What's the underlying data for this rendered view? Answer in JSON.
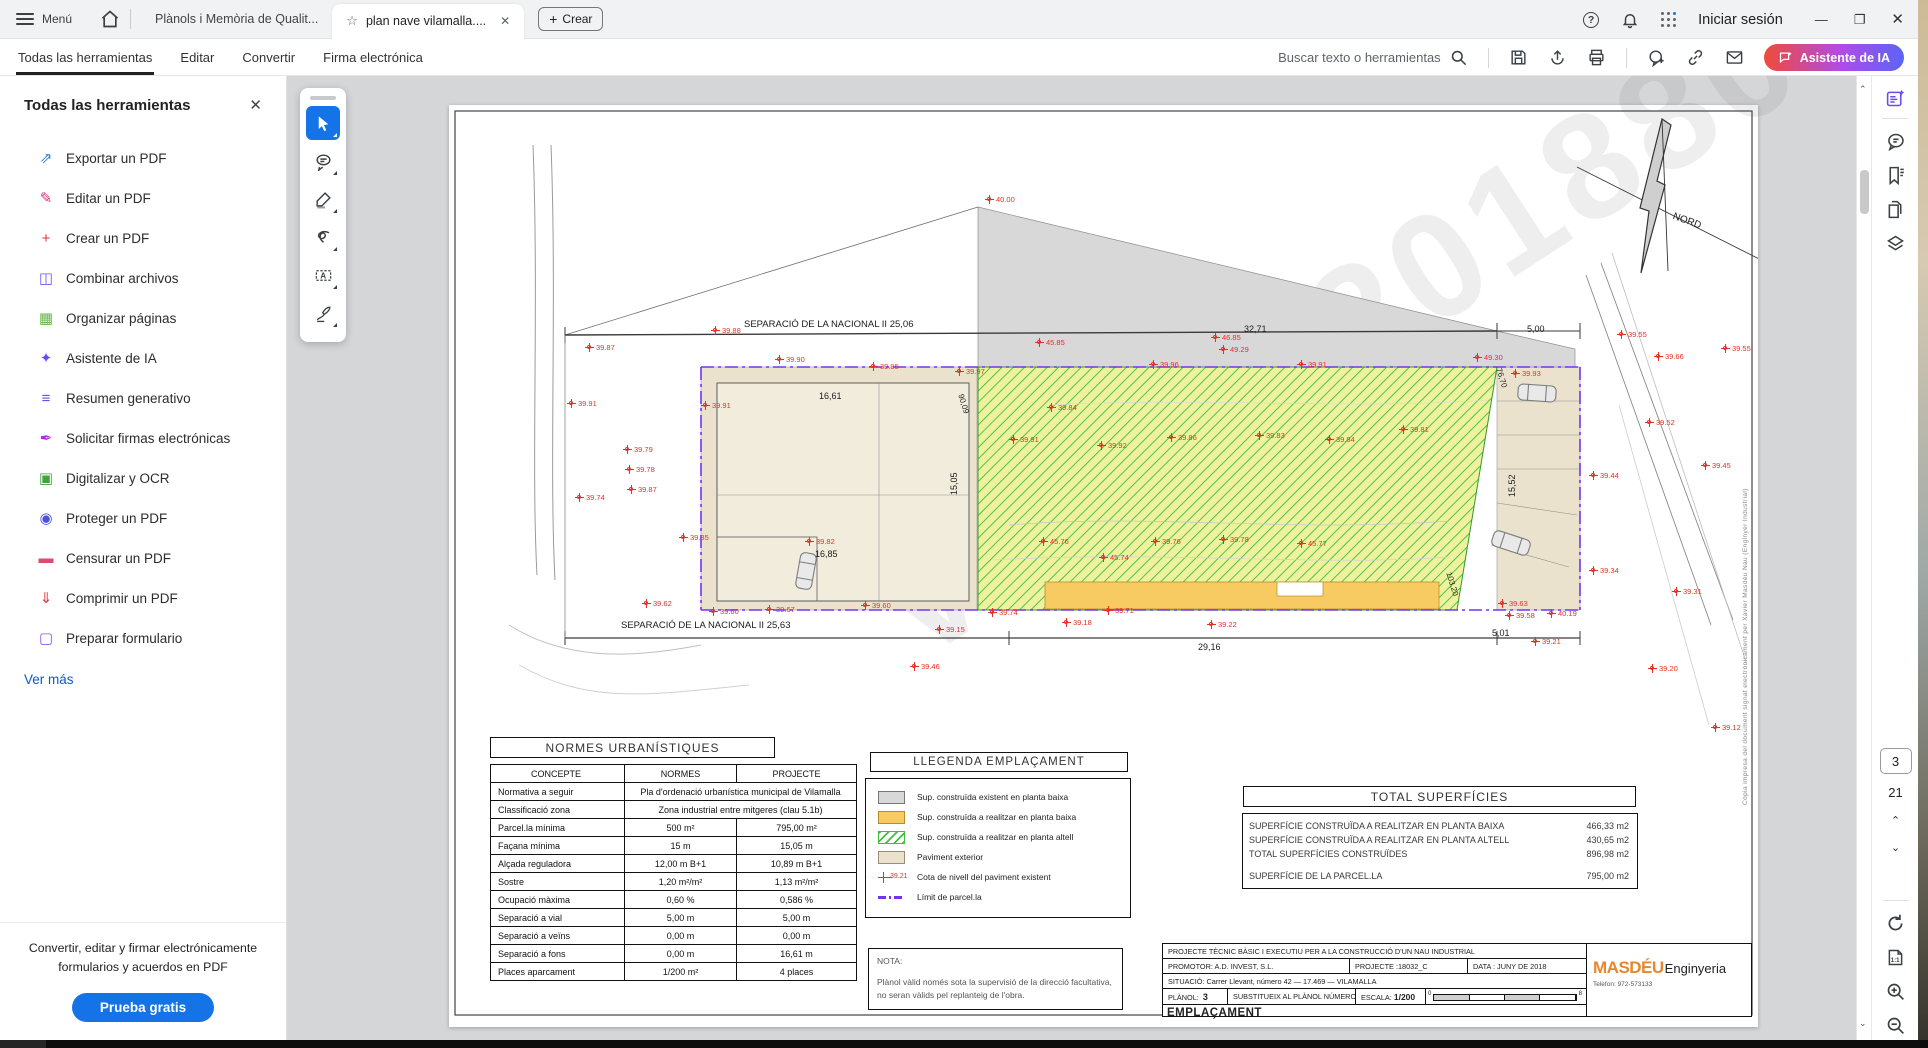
{
  "titlebar": {
    "menu": "Menú",
    "tab_inactive": "Plànols i Memòria de Qualit...",
    "tab_active": "plan nave vilamalla....",
    "create": "Crear",
    "signin": "Iniciar sesión"
  },
  "menubar": {
    "items": [
      "Todas las herramientas",
      "Editar",
      "Convertir",
      "Firma electrónica"
    ],
    "search": "Buscar texto o herramientas",
    "ai": "Asistente de IA"
  },
  "sidebar": {
    "title": "Todas las herramientas",
    "items": [
      {
        "label": "Exportar un PDF",
        "icon": "export-pdf-icon",
        "glyph": "⇗",
        "color": "#2b7de0"
      },
      {
        "label": "Editar un PDF",
        "icon": "edit-pdf-icon",
        "glyph": "✎",
        "color": "#d92d7a"
      },
      {
        "label": "Crear un PDF",
        "icon": "create-pdf-icon",
        "glyph": "+",
        "color": "#e0393b"
      },
      {
        "label": "Combinar archivos",
        "icon": "combine-files-icon",
        "glyph": "◫",
        "color": "#7155f5"
      },
      {
        "label": "Organizar páginas",
        "icon": "organize-pages-icon",
        "glyph": "▦",
        "color": "#67b346"
      },
      {
        "label": "Asistente de IA",
        "icon": "ai-assistant-icon",
        "glyph": "✦",
        "color": "#6a4cf0"
      },
      {
        "label": "Resumen generativo",
        "icon": "generative-summary-icon",
        "glyph": "≡",
        "color": "#6a4cf0"
      },
      {
        "label": "Solicitar firmas electrónicas",
        "icon": "request-signatures-icon",
        "glyph": "✒",
        "color": "#b02bd6"
      },
      {
        "label": "Digitalizar y OCR",
        "icon": "scan-ocr-icon",
        "glyph": "▣",
        "color": "#45a33f"
      },
      {
        "label": "Proteger un PDF",
        "icon": "protect-pdf-icon",
        "glyph": "◉",
        "color": "#4a53d9"
      },
      {
        "label": "Censurar un PDF",
        "icon": "redact-pdf-icon",
        "glyph": "▬",
        "color": "#d74e73"
      },
      {
        "label": "Comprimir un PDF",
        "icon": "compress-pdf-icon",
        "glyph": "⇓",
        "color": "#d9363e"
      },
      {
        "label": "Preparar formulario",
        "icon": "prepare-form-icon",
        "glyph": "▢",
        "color": "#8b53e6"
      }
    ],
    "more": "Ver más",
    "promo_line1": "Convertir, editar y firmar electrónicamente",
    "promo_line2": "formularios y acuerdos en PDF",
    "cta": "Prueba gratis"
  },
  "rightrail": {
    "page_current": "3",
    "page_total": "21"
  },
  "sheet": {
    "watermark": "VISAT 2018804",
    "side_note": "Còpia impresa del document signat electrònicament per Xavier Masdéu Nau (Enginyer Industrial)",
    "dims": [
      {
        "x": 295,
        "y": 214,
        "v": "SEPARACIÓ DE LA NACIONAL II 25,06",
        "fs": 9.5
      },
      {
        "x": 795,
        "y": 219,
        "v": "32,71"
      },
      {
        "x": 1078,
        "y": 219,
        "v": "5,00"
      },
      {
        "x": 370,
        "y": 286,
        "v": "16,61"
      },
      {
        "x": 500,
        "y": 390,
        "v": "15,05",
        "r": -90
      },
      {
        "x": 366,
        "y": 444,
        "v": "16,85"
      },
      {
        "x": 172,
        "y": 515,
        "v": "SEPARACIÓ DE LA NACIONAL II 25,63",
        "fs": 9.5
      },
      {
        "x": 749,
        "y": 537,
        "v": "29,16"
      },
      {
        "x": 1043,
        "y": 523,
        "v": "5,01"
      },
      {
        "x": 1058,
        "y": 392,
        "v": "15,52",
        "r": -90
      },
      {
        "x": 516,
        "y": 288,
        "v": "90,09",
        "r": 73,
        "fs": 8
      },
      {
        "x": 1004,
        "y": 466,
        "v": "103,20",
        "r": 73,
        "fs": 8
      },
      {
        "x": 1054,
        "y": 262,
        "v": "76,70",
        "r": 73,
        "fs": 8
      },
      {
        "x": 1226,
        "y": 106,
        "v": "NORD",
        "r": 20,
        "fs": 10
      }
    ],
    "cotas": [
      {
        "x": 536,
        "y": 90,
        "v": "40.00"
      },
      {
        "x": 262,
        "y": 221,
        "v": "39.88"
      },
      {
        "x": 136,
        "y": 238,
        "v": "39.87"
      },
      {
        "x": 586,
        "y": 233,
        "v": "45.85"
      },
      {
        "x": 762,
        "y": 228,
        "v": "46.85"
      },
      {
        "x": 770,
        "y": 240,
        "v": "49.29"
      },
      {
        "x": 326,
        "y": 250,
        "v": "39.90"
      },
      {
        "x": 420,
        "y": 257,
        "v": "39.95"
      },
      {
        "x": 506,
        "y": 262,
        "v": "39.97"
      },
      {
        "x": 700,
        "y": 255,
        "v": "39.96"
      },
      {
        "x": 848,
        "y": 255,
        "v": "39.91"
      },
      {
        "x": 1024,
        "y": 248,
        "v": "49.30"
      },
      {
        "x": 1062,
        "y": 264,
        "v": "39.93"
      },
      {
        "x": 118,
        "y": 294,
        "v": "39.91"
      },
      {
        "x": 252,
        "y": 296,
        "v": "39.91"
      },
      {
        "x": 174,
        "y": 340,
        "v": "39.79"
      },
      {
        "x": 176,
        "y": 360,
        "v": "39.78"
      },
      {
        "x": 178,
        "y": 380,
        "v": "39.87"
      },
      {
        "x": 126,
        "y": 388,
        "v": "39.74"
      },
      {
        "x": 230,
        "y": 428,
        "v": "39.85"
      },
      {
        "x": 598,
        "y": 298,
        "v": "39.84"
      },
      {
        "x": 560,
        "y": 330,
        "v": "39.91"
      },
      {
        "x": 648,
        "y": 336,
        "v": "39.92"
      },
      {
        "x": 718,
        "y": 328,
        "v": "39.86"
      },
      {
        "x": 806,
        "y": 326,
        "v": "39.83"
      },
      {
        "x": 876,
        "y": 330,
        "v": "39.84"
      },
      {
        "x": 950,
        "y": 320,
        "v": "39.81"
      },
      {
        "x": 356,
        "y": 432,
        "v": "39.82"
      },
      {
        "x": 590,
        "y": 432,
        "v": "45.76"
      },
      {
        "x": 650,
        "y": 448,
        "v": "45.74"
      },
      {
        "x": 702,
        "y": 432,
        "v": "39.76"
      },
      {
        "x": 770,
        "y": 430,
        "v": "39.78"
      },
      {
        "x": 848,
        "y": 434,
        "v": "45.77"
      },
      {
        "x": 193,
        "y": 494,
        "v": "39.62"
      },
      {
        "x": 260,
        "y": 502,
        "v": "39.60"
      },
      {
        "x": 316,
        "y": 500,
        "v": "39.67"
      },
      {
        "x": 412,
        "y": 496,
        "v": "39.60"
      },
      {
        "x": 539,
        "y": 503,
        "v": "39.74"
      },
      {
        "x": 655,
        "y": 501,
        "v": "39.71"
      },
      {
        "x": 613,
        "y": 513,
        "v": "39.18"
      },
      {
        "x": 758,
        "y": 515,
        "v": "39.22"
      },
      {
        "x": 486,
        "y": 520,
        "v": "39.15"
      },
      {
        "x": 461,
        "y": 557,
        "v": "39.46"
      },
      {
        "x": 1049,
        "y": 494,
        "v": "39.63"
      },
      {
        "x": 1056,
        "y": 506,
        "v": "39.58"
      },
      {
        "x": 1082,
        "y": 532,
        "v": "39.21"
      },
      {
        "x": 1168,
        "y": 225,
        "v": "39.55"
      },
      {
        "x": 1272,
        "y": 239,
        "v": "39.55"
      },
      {
        "x": 1205,
        "y": 247,
        "v": "39.66"
      },
      {
        "x": 1196,
        "y": 313,
        "v": "39.52"
      },
      {
        "x": 1252,
        "y": 356,
        "v": "39.45"
      },
      {
        "x": 1140,
        "y": 366,
        "v": "39.44"
      },
      {
        "x": 1140,
        "y": 461,
        "v": "39.34"
      },
      {
        "x": 1223,
        "y": 482,
        "v": "39.31"
      },
      {
        "x": 1199,
        "y": 559,
        "v": "39.20"
      },
      {
        "x": 1262,
        "y": 618,
        "v": "39.12"
      },
      {
        "x": 1098,
        "y": 504,
        "v": "40.19"
      }
    ],
    "normes": {
      "title": "NORMES URBANÍSTIQUES",
      "headers": {
        "c": "CONCEPTE",
        "n": "NORMES",
        "p": "PROJECTE"
      },
      "merged": [
        {
          "c": "Normativa a seguir",
          "v": "Pla d'ordenació urbanística municipal de Vilamalla"
        },
        {
          "c": "Classificació zona",
          "v": "Zona industrial entre mitgeres (clau 5.1b)"
        }
      ],
      "rows": [
        {
          "c": "Parcel.la mínima",
          "n": "500 m²",
          "p": "795,00 m²"
        },
        {
          "c": "Façana mínima",
          "n": "15 m",
          "p": "15,05 m"
        },
        {
          "c": "Alçada reguladora",
          "n": "12,00 m B+1",
          "p": "10,89 m B+1"
        },
        {
          "c": "Sostre",
          "n": "1,20 m²/m²",
          "p": "1,13 m²/m²"
        },
        {
          "c": "Ocupació màxima",
          "n": "0,60 %",
          "p": "0,586 %"
        },
        {
          "c": "Separació a vial",
          "n": "5,00 m",
          "p": "5,00 m"
        },
        {
          "c": "Separació a veïns",
          "n": "0,00 m",
          "p": "0,00 m"
        },
        {
          "c": "Separació a fons",
          "n": "0,00 m",
          "p": "16,61 m"
        },
        {
          "c": "Places aparcament",
          "n": "1/200 m²",
          "p": "4 places"
        }
      ]
    },
    "legend": {
      "title": "LLEGENDA EMPLAÇAMENT",
      "items": [
        {
          "sw": "gray",
          "label": "Sup. construïda existent en planta baixa"
        },
        {
          "sw": "orange",
          "label": "Sup. construïda a realitzar en planta baixa"
        },
        {
          "sw": "hatch",
          "label": "Sup. construïda a realitzar en planta altell"
        },
        {
          "sw": "beige",
          "label": "Paviment exterior"
        },
        {
          "sw": "cota",
          "sym": "39.21",
          "label": "Cota de nivell del paviment existent"
        },
        {
          "sw": "limit",
          "label": "Límit de parcel.la"
        }
      ]
    },
    "totals": {
      "title": "TOTAL SUPERFÍCIES",
      "rows": [
        {
          "label": "SUPERFÍCIE CONSTRUÏDA A REALITZAR EN PLANTA BAIXA",
          "value": "466,33 m2"
        },
        {
          "label": "SUPERFÍCIE CONSTRUÏDA A REALITZAR EN PLANTA ALTELL",
          "value": "430,65 m2"
        },
        {
          "label": "TOTAL SUPERFÍCIES  CONSTRUÏDES",
          "value": "896,98 m2"
        }
      ],
      "parcel_label": "SUPERFÍCIE DE LA PARCEL.LA",
      "parcel_value": "795,00 m2"
    },
    "nota": {
      "title": "NOTA:",
      "line1": "Plànol vàlid només sota la supervisió de la direcció facultativa,",
      "line2": "no seran vàlids pel replanteig de l'obra."
    },
    "titleblock": {
      "project": "PROJECTE TÈCNIC BÀSIC I EXECUTIU PER A LA CONSTRUCCIÓ D'UN NAU INDUSTRIAL",
      "promotor": "PROMOTOR: A.D. INVEST, S.L.",
      "projecte": "PROJECTE :18032_C",
      "data": "DATA : JUNY DE 2018",
      "situacio": "SITUACIÓ: Carrer Llevant, número 42  —  17.469  —  VILAMALLA",
      "planol_label": "PLÀNOL:",
      "planol_num": "3",
      "substitueix": "SUBSTITUEIX AL PLÀNOL NÚMERO:  —",
      "escala_label": "ESCALA:",
      "escala": "1/200",
      "scale_start": "0",
      "scale_end": "8",
      "title": "EMPLAÇAMENT",
      "firm_name": "MASDÉU",
      "firm_name2": "Enginyeria",
      "firm_phone": "Telèfon:  972-573133"
    }
  }
}
